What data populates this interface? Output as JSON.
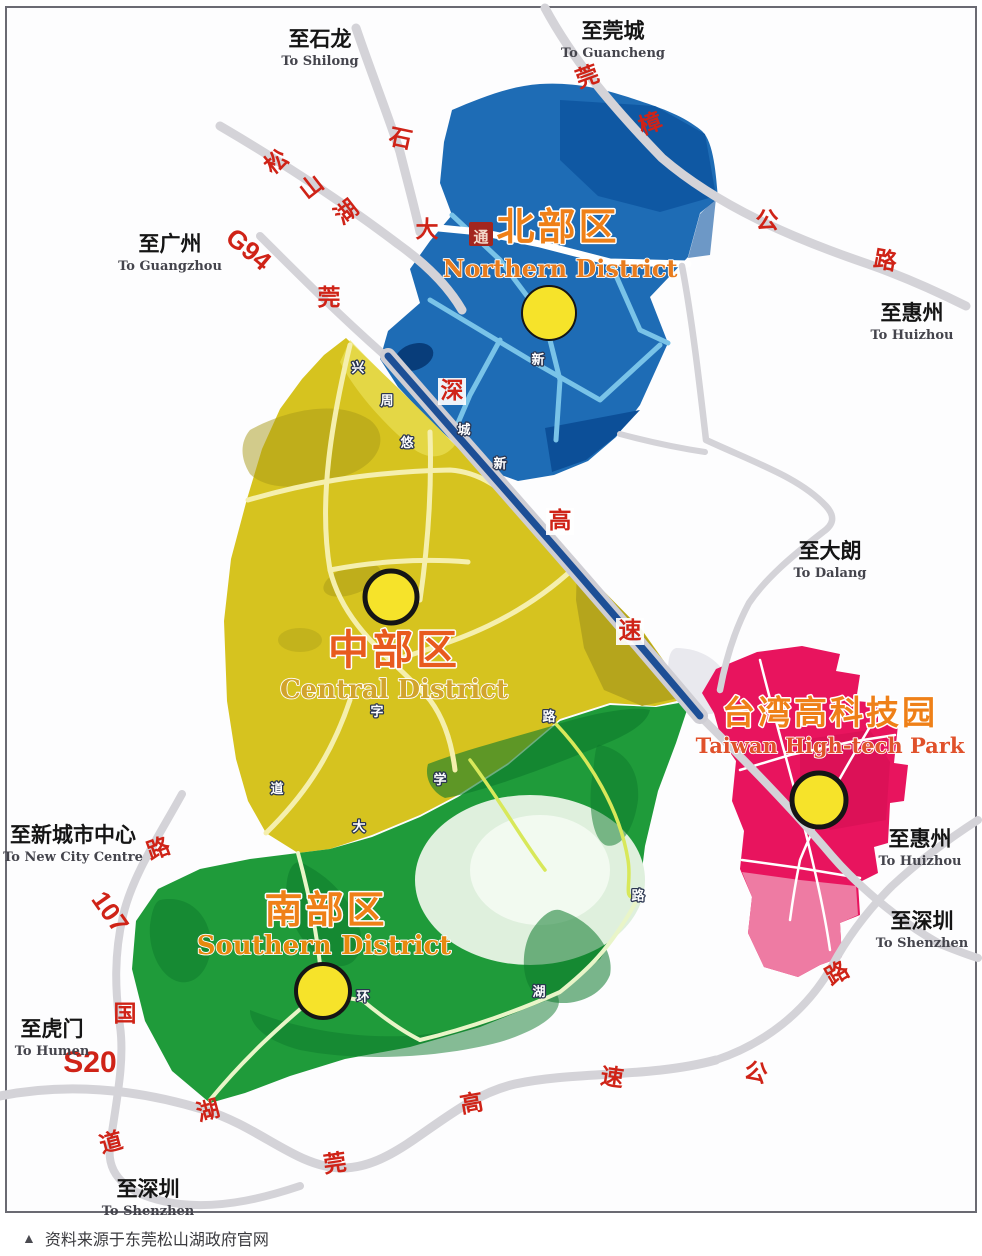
{
  "caption": "资料来源于东莞松山湖政府官网",
  "caption_marker": "▲",
  "colors": {
    "north_blue": "#1e6cb5",
    "central_yellow": "#d6c31f",
    "south_green": "#1f9b3a",
    "taiwan_pink": "#e8145e",
    "road_gray": "#d4d3d8",
    "expressway_blue": "#1d4f96",
    "marker_yellow": "#f6e32a",
    "road_label_red": "#cf2317"
  },
  "districts": [
    {
      "id": "north",
      "zh": "北部区",
      "en": "Northern District",
      "color": "#1e6cb5",
      "zh_color": "#ef8018",
      "en_color": "#e87c1e",
      "zh_x": 558,
      "zh_y": 240,
      "en_x": 560,
      "en_y": 277,
      "zh_size": 38,
      "en_size": 24,
      "marker": {
        "x": 549,
        "y": 313,
        "r": 27,
        "ring": 2
      }
    },
    {
      "id": "central",
      "zh": "中部区",
      "en": "Central District",
      "color": "#d6c31f",
      "zh_color": "#e85a1e",
      "en_color": "#d2a42c",
      "zh_x": 394,
      "zh_y": 664,
      "en_x": 394,
      "en_y": 698,
      "zh_size": 41,
      "en_size": 26,
      "marker": {
        "x": 391,
        "y": 597,
        "r": 26,
        "ring": 5
      }
    },
    {
      "id": "south",
      "zh": "南部区",
      "en": "Southern District",
      "color": "#1f9b3a",
      "zh_color": "#ef8018",
      "en_color": "#e8890e",
      "zh_x": 326,
      "zh_y": 923,
      "en_x": 324,
      "en_y": 954,
      "zh_size": 38,
      "en_size": 26,
      "marker": {
        "x": 323,
        "y": 991,
        "r": 27,
        "ring": 4
      }
    },
    {
      "id": "taiwan",
      "zh": "台湾高科技园",
      "en": "Taiwan High-tech Park",
      "color": "#e8145e",
      "zh_color": "#ef8018",
      "en_color": "#e0512b",
      "zh_x": 830,
      "zh_y": 724,
      "en_x": 830,
      "en_y": 753,
      "zh_size": 33,
      "en_size": 21,
      "marker": {
        "x": 819,
        "y": 800,
        "r": 27,
        "ring": 5
      }
    }
  ],
  "directions": [
    {
      "zh": "至石龙",
      "en": "To Shilong",
      "x": 320,
      "y": 40
    },
    {
      "zh": "至莞城",
      "en": "To Guancheng",
      "x": 613,
      "y": 32
    },
    {
      "zh": "至广州",
      "en": "To Guangzhou",
      "x": 170,
      "y": 245
    },
    {
      "zh": "至惠州",
      "en": "To Huizhou",
      "x": 912,
      "y": 314
    },
    {
      "zh": "至大朗",
      "en": "To Dalang",
      "x": 830,
      "y": 552
    },
    {
      "zh": "至惠州",
      "en": "To Huizhou",
      "x": 920,
      "y": 840
    },
    {
      "zh": "至深圳",
      "en": "To Shenzhen",
      "x": 922,
      "y": 922
    },
    {
      "zh": "至新城市中心",
      "en": "To New City Centre",
      "x": 73,
      "y": 836
    },
    {
      "zh": "至虎门",
      "en": "To Humen",
      "x": 52,
      "y": 1030
    },
    {
      "zh": "至深圳",
      "en": "To Shenzhen",
      "x": 148,
      "y": 1190
    }
  ],
  "road_labels": [
    {
      "t": "石",
      "x": 399,
      "y": 146,
      "r": 12
    },
    {
      "t": "松",
      "x": 281,
      "y": 168,
      "r": -38
    },
    {
      "t": "山",
      "x": 316,
      "y": 193,
      "r": -38
    },
    {
      "t": "湖",
      "x": 351,
      "y": 218,
      "r": -38
    },
    {
      "t": "大",
      "x": 427,
      "y": 237,
      "r": 0
    },
    {
      "t": "通",
      "x": 481,
      "y": 238,
      "r": 0,
      "box": "red"
    },
    {
      "t": "G94",
      "x": 243,
      "y": 256,
      "r": 40,
      "size": 26
    },
    {
      "t": "莞",
      "x": 329,
      "y": 305,
      "r": 0
    },
    {
      "t": "莞",
      "x": 590,
      "y": 84,
      "r": -20
    },
    {
      "t": "樟",
      "x": 653,
      "y": 131,
      "r": -20
    },
    {
      "t": "公",
      "x": 767,
      "y": 228,
      "r": 0
    },
    {
      "t": "路",
      "x": 884,
      "y": 268,
      "r": 10
    },
    {
      "t": "深",
      "x": 452,
      "y": 398,
      "r": 0,
      "box": "white"
    },
    {
      "t": "高",
      "x": 560,
      "y": 528,
      "r": 0,
      "box": "white"
    },
    {
      "t": "速",
      "x": 630,
      "y": 638,
      "r": 0,
      "box": "white"
    },
    {
      "t": "路",
      "x": 841,
      "y": 980,
      "r": -30
    },
    {
      "t": "公",
      "x": 754,
      "y": 1080,
      "r": 15
    },
    {
      "t": "速",
      "x": 611,
      "y": 1085,
      "r": 8
    },
    {
      "t": "高",
      "x": 473,
      "y": 1111,
      "r": -10
    },
    {
      "t": "莞",
      "x": 336,
      "y": 1171,
      "r": -8
    },
    {
      "t": "湖",
      "x": 210,
      "y": 1118,
      "r": -15
    },
    {
      "t": "路",
      "x": 161,
      "y": 856,
      "r": -20
    },
    {
      "t": "107",
      "x": 103,
      "y": 917,
      "r": 55,
      "size": 26
    },
    {
      "t": "国",
      "x": 125,
      "y": 1021,
      "r": 0
    },
    {
      "t": "道",
      "x": 113,
      "y": 1150,
      "r": -15
    },
    {
      "t": "S20",
      "x": 90,
      "y": 1072,
      "r": 0,
      "size": 30
    }
  ],
  "minor_labels": [
    {
      "t": "兴",
      "x": 358,
      "y": 372
    },
    {
      "t": "周",
      "x": 387,
      "y": 405
    },
    {
      "t": "悠",
      "x": 407,
      "y": 447
    },
    {
      "t": "城",
      "x": 464,
      "y": 434
    },
    {
      "t": "新",
      "x": 500,
      "y": 468
    },
    {
      "t": "新",
      "x": 538,
      "y": 364
    },
    {
      "t": "字",
      "x": 377,
      "y": 716
    },
    {
      "t": "路",
      "x": 549,
      "y": 721
    },
    {
      "t": "学",
      "x": 440,
      "y": 784
    },
    {
      "t": "大",
      "x": 359,
      "y": 831
    },
    {
      "t": "道",
      "x": 277,
      "y": 793
    },
    {
      "t": "环",
      "x": 363,
      "y": 1001
    },
    {
      "t": "湖",
      "x": 539,
      "y": 996
    },
    {
      "t": "路",
      "x": 638,
      "y": 900
    }
  ]
}
